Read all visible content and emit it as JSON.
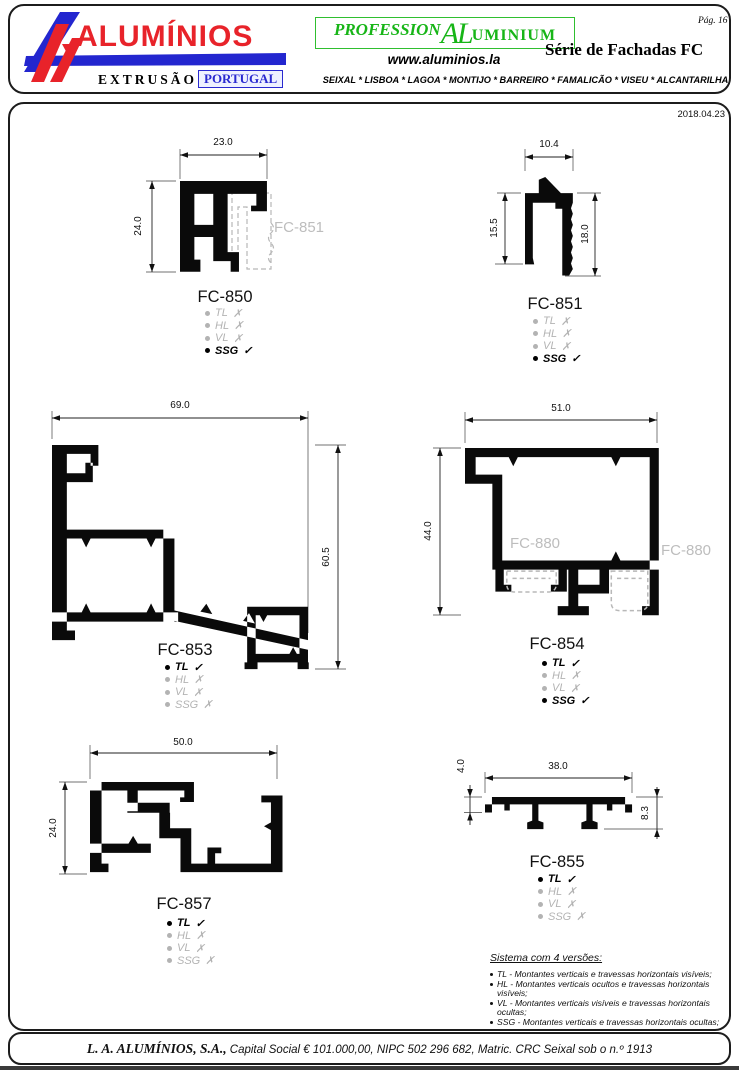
{
  "page": {
    "number": "Pág. 16",
    "date": "2018.04.23"
  },
  "header": {
    "brand": "ALUMÍNIOS",
    "extrusao": "EXTRUSÃO",
    "portugal": "PORTUGAL",
    "professional": {
      "p1": "PROFESSION",
      "p2": "AL",
      "p3": "UMINIUM"
    },
    "website": "www.aluminios.la",
    "series": "Série de Fachadas FC",
    "locations": "SEIXAL * LISBOA * LAGOA * MONTIJO * BARREIRO * FAMALICÃO * VISEU * ALCANTARILHA"
  },
  "profiles": [
    {
      "name": "FC-850",
      "dim_top": "23.0",
      "dim_left": "24.0",
      "ghost": "FC-851",
      "versions": [
        {
          "label": "TL",
          "mark": "✗",
          "active": false
        },
        {
          "label": "HL",
          "mark": "✗",
          "active": false
        },
        {
          "label": "VL",
          "mark": "✗",
          "active": false
        },
        {
          "label": "SSG",
          "mark": "✓",
          "active": true
        }
      ]
    },
    {
      "name": "FC-851",
      "dim_top": "10.4",
      "dim_left": "15.5",
      "dim_right": "18.0",
      "versions": [
        {
          "label": "TL",
          "mark": "✗",
          "active": false
        },
        {
          "label": "HL",
          "mark": "✗",
          "active": false
        },
        {
          "label": "VL",
          "mark": "✗",
          "active": false
        },
        {
          "label": "SSG",
          "mark": "✓",
          "active": true
        }
      ]
    },
    {
      "name": "FC-853",
      "dim_top": "69.0",
      "dim_right": "60.5",
      "versions": [
        {
          "label": "TL",
          "mark": "✓",
          "active": true
        },
        {
          "label": "HL",
          "mark": "✗",
          "active": false
        },
        {
          "label": "VL",
          "mark": "✗",
          "active": false
        },
        {
          "label": "SSG",
          "mark": "✗",
          "active": false
        }
      ]
    },
    {
      "name": "FC-854",
      "dim_top": "51.0",
      "dim_left": "44.0",
      "ghost1": "FC-880",
      "ghost2": "FC-880",
      "versions": [
        {
          "label": "TL",
          "mark": "✓",
          "active": true
        },
        {
          "label": "HL",
          "mark": "✗",
          "active": false
        },
        {
          "label": "VL",
          "mark": "✗",
          "active": false
        },
        {
          "label": "SSG",
          "mark": "✓",
          "active": true
        }
      ]
    },
    {
      "name": "FC-857",
      "dim_top": "50.0",
      "dim_left": "24.0",
      "versions": [
        {
          "label": "TL",
          "mark": "✓",
          "active": true
        },
        {
          "label": "HL",
          "mark": "✗",
          "active": false
        },
        {
          "label": "VL",
          "mark": "✗",
          "active": false
        },
        {
          "label": "SSG",
          "mark": "✗",
          "active": false
        }
      ]
    },
    {
      "name": "FC-855",
      "dim_top": "38.0",
      "dim_topleft": "4.0",
      "dim_right": "8.3",
      "versions": [
        {
          "label": "TL",
          "mark": "✓",
          "active": true
        },
        {
          "label": "HL",
          "mark": "✗",
          "active": false
        },
        {
          "label": "VL",
          "mark": "✗",
          "active": false
        },
        {
          "label": "SSG",
          "mark": "✗",
          "active": false
        }
      ]
    }
  ],
  "note": {
    "title": "Sistema com 4 versões:",
    "items": [
      "TL - Montantes verticais e travessas horizontais visíveis;",
      "HL - Montantes verticais ocultos e travessas horizontais visíveis;",
      "VL - Montantes verticais visíveis e travessas horizontais ocultas;",
      "SSG - Montantes verticais e travessas horizontais ocultas;"
    ]
  },
  "footer": {
    "company": "L. A. ALUMÍNIOS, S.A.,",
    "details": " Capital Social € 101.000,00, NIPC 502 296 682, Matric. CRC Seixal sob o n.º 1913"
  },
  "colors": {
    "brand_red": "#e8232a",
    "brand_blue": "#2326cf",
    "brand_green": "#17b517",
    "ghost_gray": "#b8b8b8"
  }
}
